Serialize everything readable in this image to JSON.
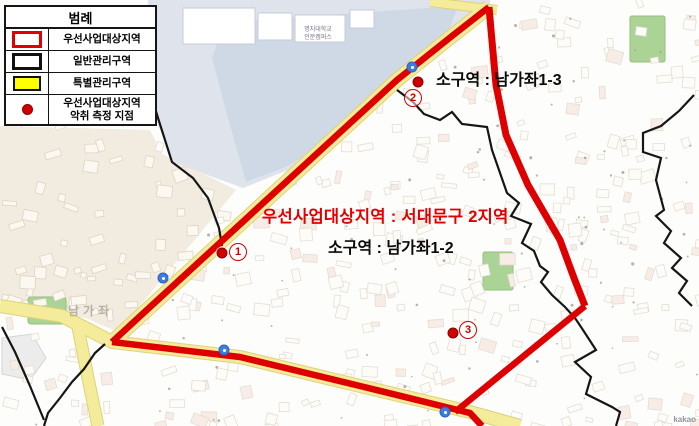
{
  "legend": {
    "title": "범례",
    "items": [
      {
        "swatch": "red-outline",
        "label": "우선사업대상지역"
      },
      {
        "swatch": "black-outline",
        "label": "일반관리구역"
      },
      {
        "swatch": "yellow-fill",
        "label": "특별관리구역"
      },
      {
        "swatch": "red-dot",
        "label": "우선사업대상지역",
        "label2": "악취 측정 지점"
      }
    ]
  },
  "map": {
    "labels": {
      "subzone_1_3": "소구역 : 남가좌1-3",
      "priority_area": "우선사업대상지역 : 서대문구 2지역",
      "subzone_1_2": "소구역 : 남가좌1-2",
      "district_watermark": "남가좌",
      "campus_line1": "명지대학교",
      "campus_line2": "인문캠퍼스",
      "attribution": "kakao"
    },
    "markers": [
      {
        "number": "1",
        "dot": {
          "x": 222,
          "y": 253
        },
        "circle": {
          "x": 238,
          "y": 252
        }
      },
      {
        "number": "2",
        "dot": {
          "x": 418,
          "y": 82
        },
        "circle": {
          "x": 413,
          "y": 98
        }
      },
      {
        "number": "3",
        "dot": {
          "x": 453,
          "y": 333
        },
        "circle": {
          "x": 468,
          "y": 330
        }
      }
    ],
    "transit_icons": [
      {
        "x": 412,
        "y": 67
      },
      {
        "x": 163,
        "y": 278
      },
      {
        "x": 445,
        "y": 412
      },
      {
        "x": 224,
        "y": 350
      }
    ]
  },
  "colors": {
    "boundary_red": "#de0000",
    "marker_red": "#cc0000",
    "label_red": "#e00000",
    "zone_black": "#161616",
    "special_yellow": "#ffff00",
    "road_yellow": "#f5ec9b",
    "road_yellow_edge": "#ddd27a",
    "campus_blue": "#dfe3ec",
    "water_blue": "#cfd9e6",
    "residential_beige": "#f2ebdf",
    "park_green": "#abd396",
    "subway_blue": "#3f7ce0"
  }
}
